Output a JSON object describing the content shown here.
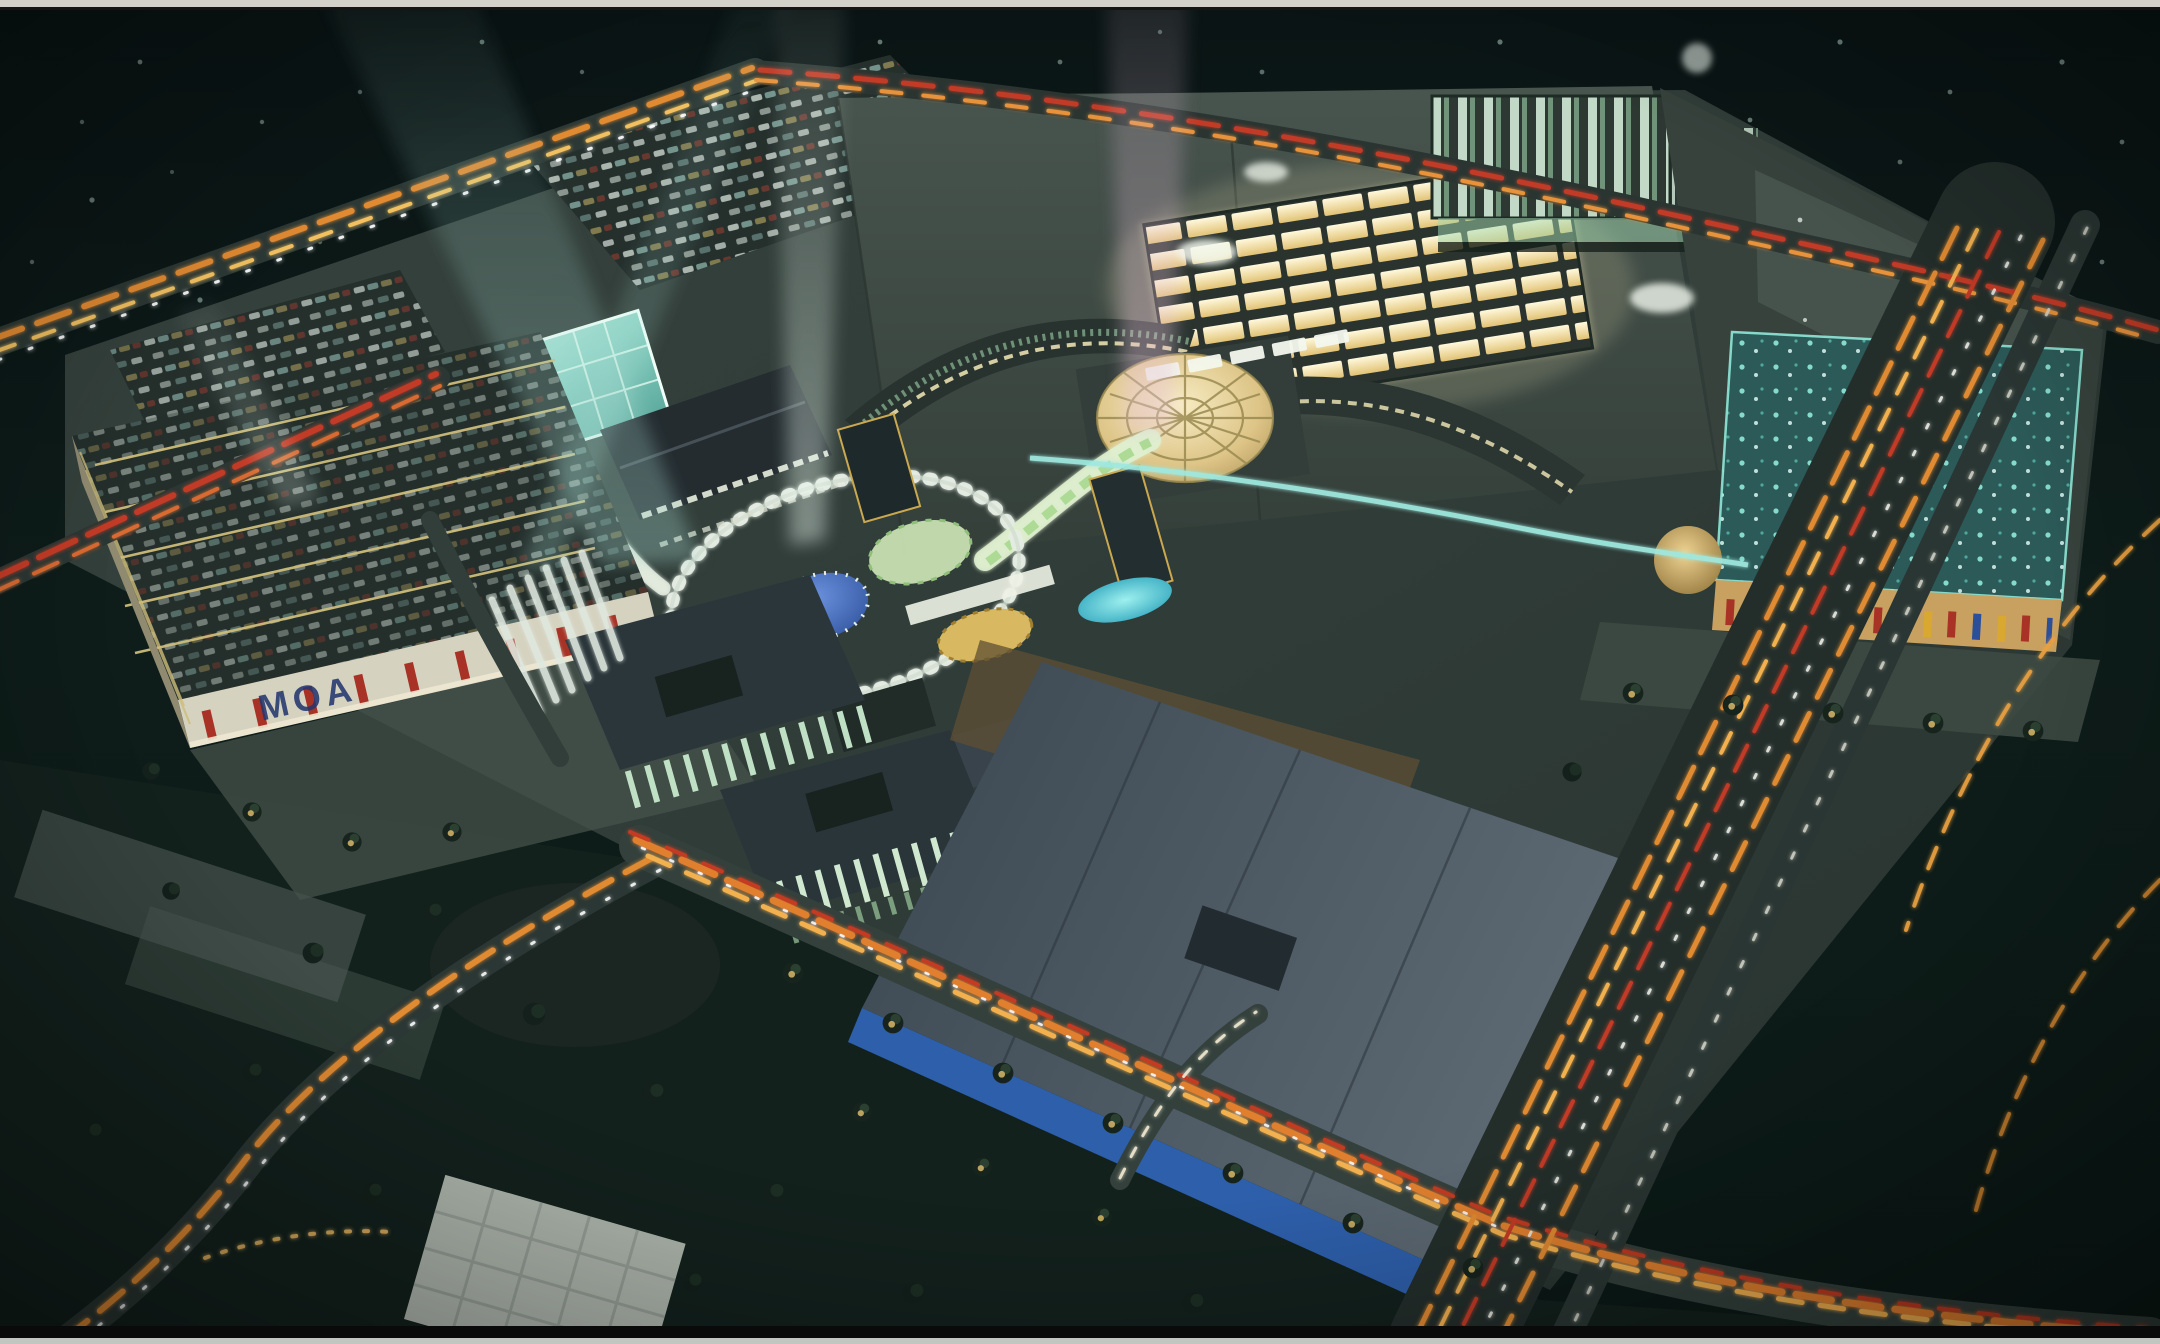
{
  "scene": {
    "description": "Aerial night-time architectural rendering of a large mixed-use shopping mall development with light beams, lit skylights, parking structures and highways with light trails",
    "signage": {
      "garage_sign": "MOA"
    },
    "palette": {
      "night_sky": "#0c1917",
      "terrain": "#313d39",
      "anchor_roof": "#3f4b46",
      "skylight_warm": "#f6ecc0",
      "glass_atrium_teal": "#8fd4c6",
      "tower_green": "#b4e0c0",
      "pool_turquoise": "#4ac8d6",
      "roof_disc_blue": "#3b62b4",
      "trail_orange": "#e08a33",
      "trail_red": "#c23b26",
      "banner_red": "#a83226",
      "box_wall_blue": "#2e5faa",
      "beam_teal": "#aadcd2",
      "beam_pink": "#e6c2d8"
    }
  }
}
